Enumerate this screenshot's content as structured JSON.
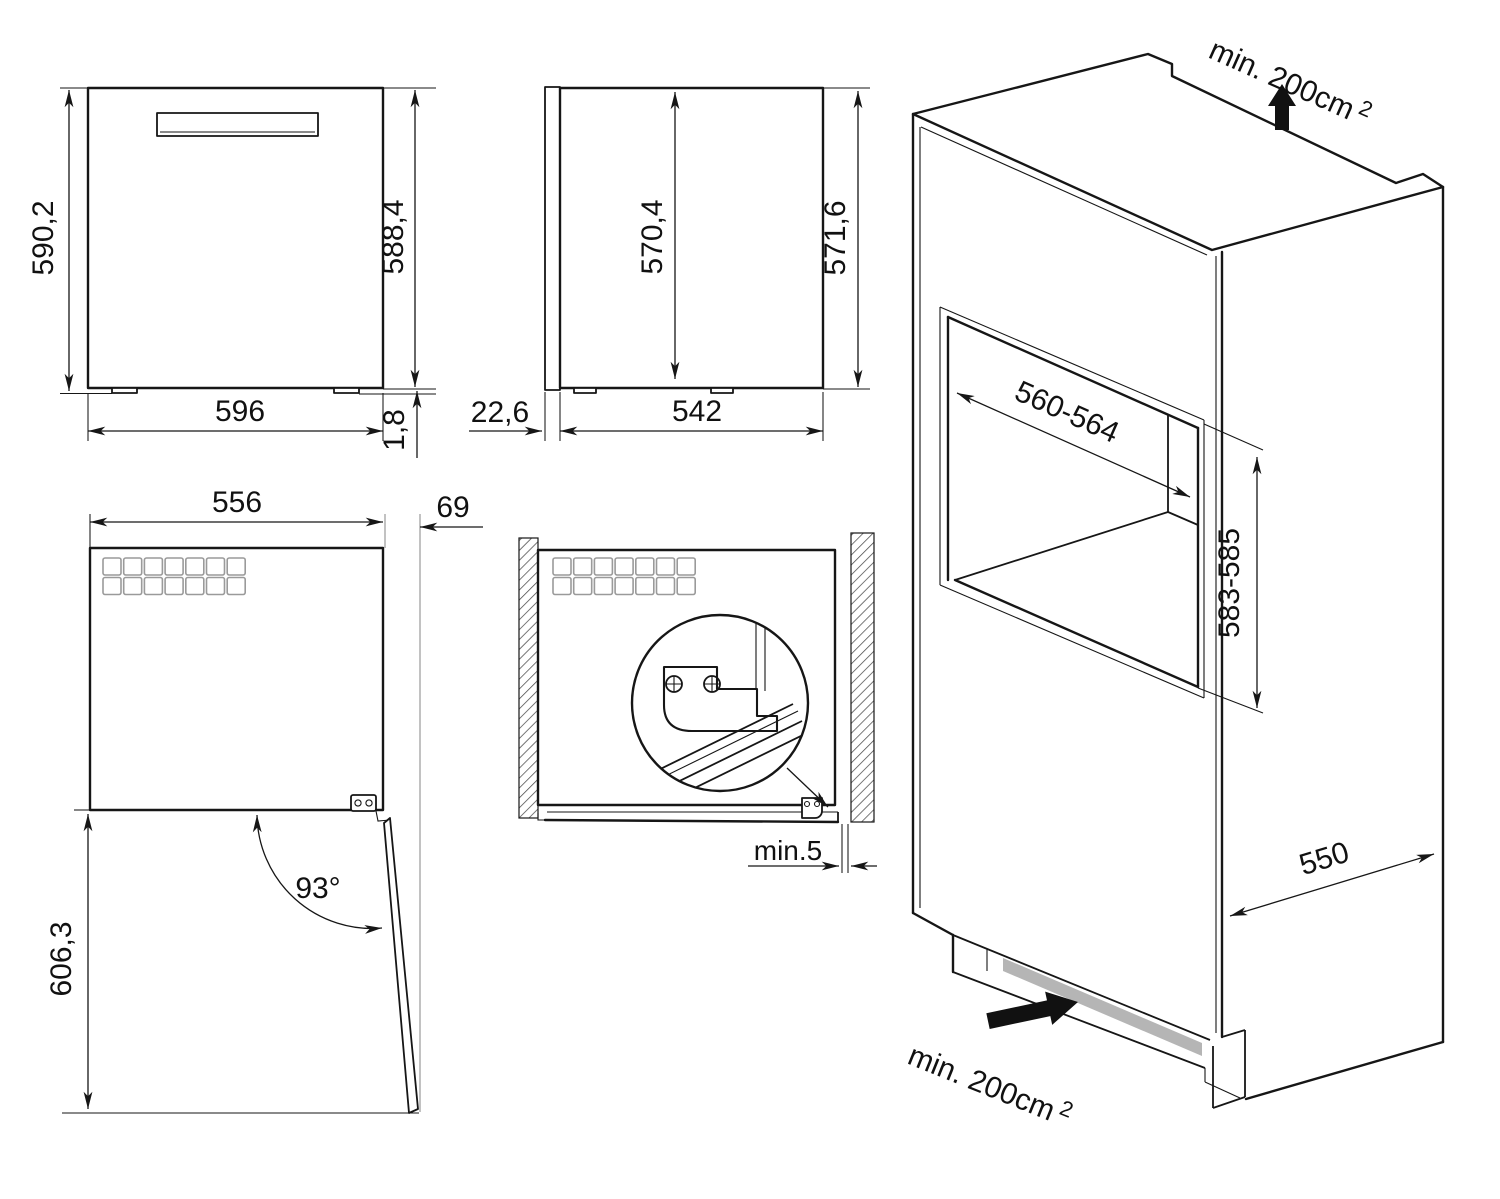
{
  "drawing": {
    "front_view": {
      "overall_height": "590,2",
      "body_height": "588,4",
      "width": "596",
      "foot_height": "1,8"
    },
    "side_view": {
      "interior_height": "570,4",
      "rear_height": "571,6",
      "door_thickness": "22,6",
      "body_depth": "542"
    },
    "plan_view": {
      "body_width": "556",
      "door_projection": "69",
      "opening_angle": "93°",
      "swing_clearance": "606,3"
    },
    "install_view": {
      "side_clearance": "min.5"
    },
    "cabinet_view": {
      "niche_width": "560-564",
      "niche_height": "583-585",
      "cabinet_depth": "550",
      "vent_top": {
        "label": "min. 200cm",
        "sup": "2"
      },
      "vent_bottom": {
        "label": "min. 200cm",
        "sup": "2"
      }
    },
    "colors": {
      "line": "#161616",
      "extension": "#9a9a9a",
      "vent_slot": "#b5b5b5"
    }
  }
}
